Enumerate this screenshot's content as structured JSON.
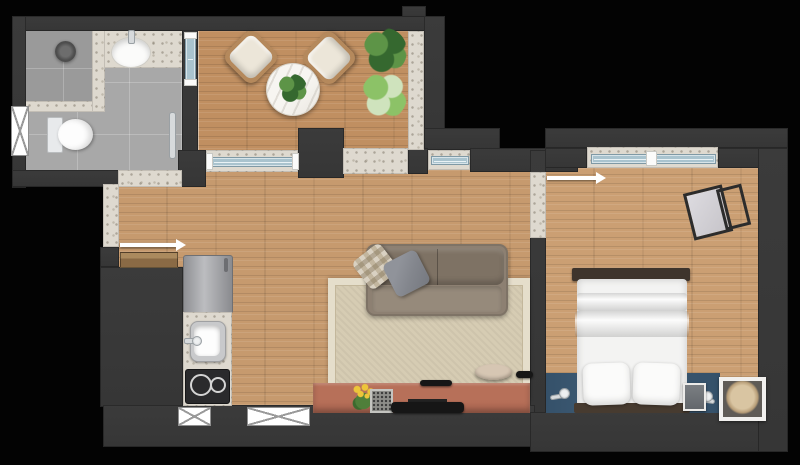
{
  "meta": {
    "kind": "apartment-floor-plan",
    "view": "top-down",
    "has_text": false
  },
  "palette": {
    "bg": "#030303",
    "wall": "#363636",
    "wood_living": "#c69a6e",
    "wood_balcony": "#c08f61",
    "wood_bedroom": "#cb9f73",
    "tile": "#a8a8a8",
    "tile_dark": "#9a9a9a",
    "terrazzo": "#ded9cf",
    "glass": "#a9c3ce",
    "steel": "#c8c9cb",
    "cooktop": "#2a2a2c",
    "sofa": "#8d8072",
    "sofa_dark": "#7e7264",
    "pillow_gray": "#83868d",
    "pillow_check_a": "#d9d1c2",
    "rug": "#d6ccb3",
    "rug_border": "#e5decb",
    "console": "#ad6752",
    "tv": "#161616",
    "stool": "#c9b7a3",
    "bed_white": "#f3f3f2",
    "bed_frame": "#3e342c",
    "headboard": "#473b30",
    "accent_blue": "#3d5a73",
    "chrome": "#d7dadc",
    "chrome_dark": "#9aa0a4",
    "chair_wood": "#b5895c",
    "cushion": "#ece6d9",
    "plant_dark": "#35682f",
    "plant_mid": "#5d9447",
    "plant_light": "#8cc267",
    "plant_pale": "#cfe3bd",
    "flower_yellow": "#edc53a",
    "flower_green": "#4f7f3a",
    "door_leaf": "#8a6a45",
    "door_leaf_light": "#ab8a5e",
    "art_mat": "#5f5b56",
    "art_paper": "#d9c5a2",
    "frame_white": "#f1f0ee"
  },
  "rooms": {
    "bathroom": {
      "fixtures": [
        "shower-head",
        "vanity-sink",
        "toilet",
        "towel-rail",
        "window"
      ]
    },
    "balcony": {
      "furniture": [
        "armchair",
        "armchair",
        "round-table",
        "table-plant",
        "potted-plant",
        "potted-plant"
      ]
    },
    "living_kitchen": {
      "furniture": [
        "refrigerator",
        "kitchen-sink",
        "cooktop",
        "sofa",
        "pillows",
        "rug",
        "stool",
        "tv-console",
        "tv",
        "flower-vase",
        "photo-frame",
        "remote"
      ]
    },
    "bedroom": {
      "furniture": [
        "double-bed",
        "pillows",
        "foot-bench",
        "wall-sconce",
        "wall-sconce",
        "mini-frame",
        "framed-art",
        "desk",
        "chair"
      ]
    },
    "openings": [
      "entry-door",
      "bathroom-door",
      "bedroom-door",
      "balcony-sliding-door",
      "balcony-passage",
      "living-window",
      "bedroom-window",
      "bathroom-window",
      "facade-window",
      "facade-window",
      "side-window"
    ]
  }
}
